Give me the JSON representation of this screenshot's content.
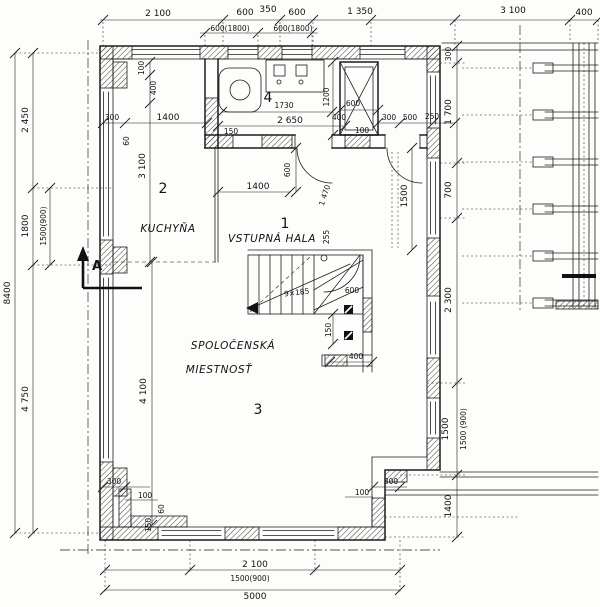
{
  "rooms": {
    "hall": {
      "no": "1",
      "name": "VSTUPNÁ HALA"
    },
    "kitchen": {
      "no": "2",
      "name": "KUCHYŇA"
    },
    "living": {
      "no": "3",
      "name1": "SPOLOČENSKÁ",
      "name2": "MIESTNOSŤ"
    },
    "bath": {
      "no": "4"
    }
  },
  "stairs": {
    "note": "9×185"
  },
  "section": {
    "label": "A"
  },
  "dims": {
    "t1": "2 100",
    "t2": "600",
    "t3": "350",
    "t4": "600",
    "t5": "1 350",
    "t6": "3 100",
    "t7": "400",
    "t8": "600(1800)",
    "t9": "600(1800)",
    "l1": "2 450",
    "l2": "1800",
    "l3": "1500(900)",
    "l4": "8400",
    "l5": "4 750",
    "b1": "2 100",
    "b2": "1500(900)",
    "b3": "5000",
    "r1": "300",
    "r2": "1 700",
    "r3": "700",
    "r4": "2 300",
    "r5": "1500",
    "r6": "1500 (900)",
    "r7": "1400",
    "i1": "300",
    "i2": "1400",
    "i3": "60",
    "i4": "100",
    "i5": "400",
    "i6": "3 100",
    "i7": "1400",
    "i8": "600",
    "i9": "1730",
    "i10": "2 650",
    "i11": "150",
    "i12": "1200",
    "i13": "600",
    "i14": "400",
    "i15": "100",
    "i16": "300",
    "i17": "500",
    "i18": "250",
    "i19": "1 470",
    "i20": "1500",
    "i21": "255",
    "i22": "600",
    "i23": "150",
    "i24": "400",
    "i25": "4 100",
    "i26": "300",
    "i27": "100",
    "i28": "60",
    "i29": "150",
    "i30": "300",
    "i31": "100"
  }
}
